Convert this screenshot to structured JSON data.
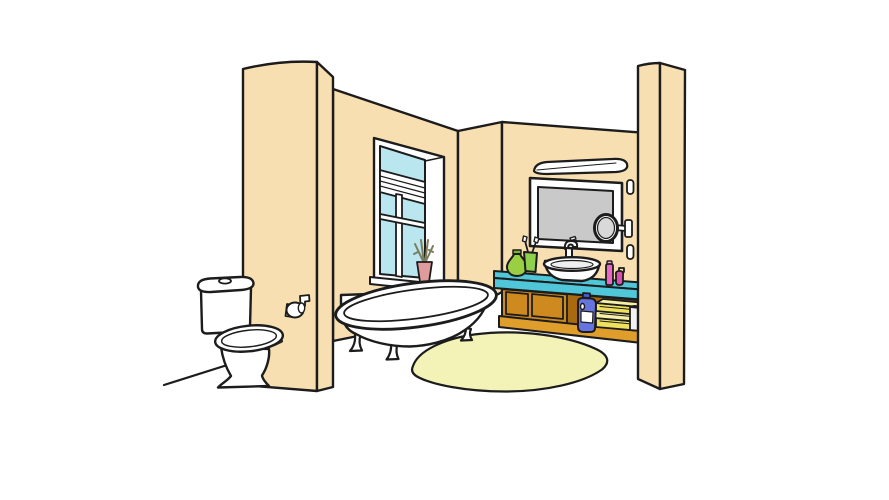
{
  "scene": {
    "kind": "cartoon-bathroom-illustration",
    "objects": [
      "left-wall-partition",
      "back-wall",
      "corner-wall",
      "alcove-wall",
      "right-wall-pillar",
      "window",
      "roller-blind",
      "window-plant-vase",
      "toilet",
      "toilet-paper-holder",
      "bathtub",
      "rug",
      "floor-line",
      "light-fixture",
      "mirror",
      "magnifying-mirror",
      "wall-buttons",
      "countertop",
      "cabinet",
      "towel-stack",
      "rolled-towel",
      "detergent-bottle",
      "soap-bottle",
      "toothbrush-cup",
      "wash-basin",
      "faucet",
      "lotion-bottle",
      "pump-bottle"
    ]
  },
  "colors": {
    "background": "#FFFFFF",
    "outline": "#1C1C1C",
    "wall": "#F8DFB1",
    "porcelain": "#FFFFFF",
    "porcelain_shade": "#EFEFEF",
    "window_glass": "#B9E6EF",
    "mirror_glass": "#C9C9C9",
    "magnifier_glass": "#D9D9D9",
    "counter": "#4FC7D9",
    "cabinet_wood": "#CE8A1E",
    "cabinet_interior": "#A9690F",
    "cabinet_base": "#DF9E2C",
    "towel_yellow": "#EDE15E",
    "towel_yellow_light": "#F6F0A6",
    "towel_white": "#F2F2F2",
    "rug": "#F3F3B8",
    "bottle_blue": "#6674DD",
    "bottle_blue_cap": "#4C5BD0",
    "bottle_green": "#9ACF44",
    "bottle_green_cap": "#76B32E",
    "cup_green": "#8FD14C",
    "bottle_pink": "#E868C4",
    "bottle_pink_cap": "#F2ABDC",
    "bottle_magenta": "#D84FB0",
    "vase": "#E09C9C",
    "plant": "#7C7C5E",
    "seat_shadow": "#2E2E2E"
  }
}
